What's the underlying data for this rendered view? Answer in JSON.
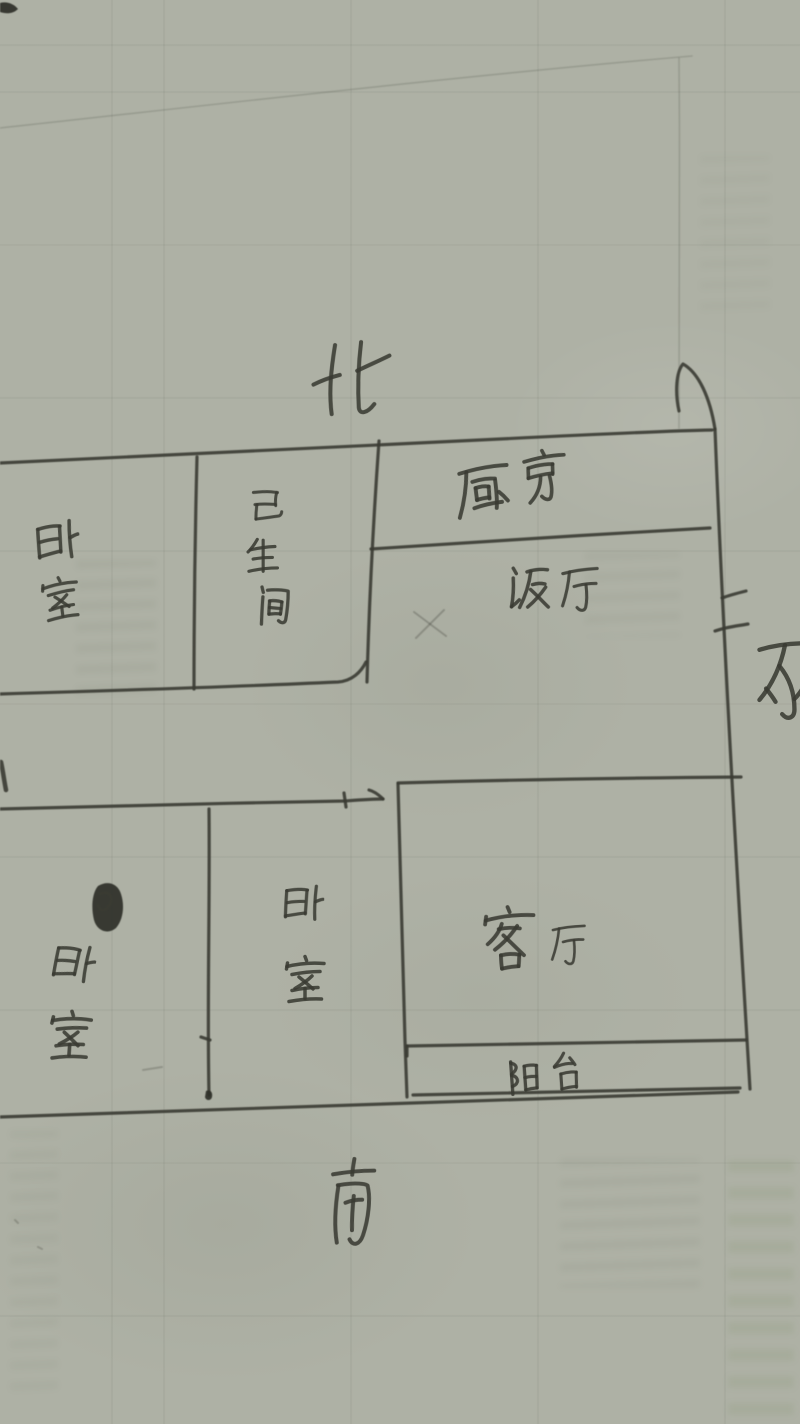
{
  "meta": {
    "description": "Hand-drawn apartment floor plan sketch photographed on grey-green paper",
    "paper_color": "#aeb1a5",
    "ink_color": "#3a3b33"
  },
  "compass": {
    "north": "北",
    "south": "南",
    "east": "东"
  },
  "rooms": {
    "bedroom_nw": "卧室",
    "bathroom": "卫生间",
    "kitchen": "厨房",
    "dining": "饭厅",
    "bedroom_sw": "卧室",
    "bedroom_sm": "卧室",
    "living_room": "客厅",
    "balcony": "阳台"
  }
}
